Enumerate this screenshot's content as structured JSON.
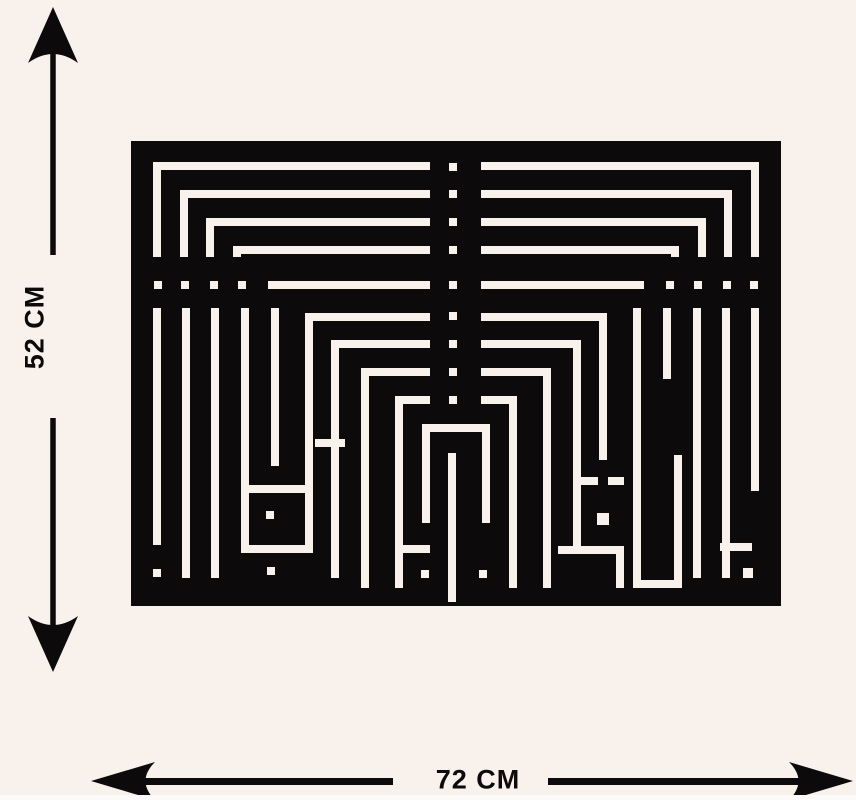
{
  "labels": {
    "height": "52 CM",
    "width": "72 CM"
  },
  "colors": {
    "background": "#f8f1ec",
    "ink": "#0d0a0b",
    "artwork_black": "#0d0a0b",
    "artwork_line": "#f8f1ec"
  },
  "artwork": {
    "type": "square-kufic-calligraphy-wall-art",
    "x": 131,
    "y": 141,
    "width": 650,
    "height": 465,
    "line_thickness": 8,
    "white_rects": [
      [
        22,
        21,
        277,
        8
      ],
      [
        350,
        21,
        278,
        8
      ],
      [
        22,
        21,
        8,
        95
      ],
      [
        620,
        21,
        8,
        95
      ],
      [
        49,
        49,
        250,
        8
      ],
      [
        350,
        49,
        251,
        8
      ],
      [
        49,
        49,
        8,
        67
      ],
      [
        593,
        49,
        8,
        67
      ],
      [
        75,
        77,
        224,
        8
      ],
      [
        350,
        77,
        225,
        8
      ],
      [
        75,
        77,
        8,
        39
      ],
      [
        567,
        77,
        8,
        39
      ],
      [
        102,
        105,
        197,
        8
      ],
      [
        350,
        105,
        198,
        8
      ],
      [
        102,
        105,
        8,
        11
      ],
      [
        540,
        105,
        8,
        11
      ],
      [
        137,
        140,
        162,
        8
      ],
      [
        350,
        140,
        163,
        8
      ],
      [
        23,
        140,
        8,
        8
      ],
      [
        50,
        140,
        8,
        8
      ],
      [
        79,
        140,
        8,
        8
      ],
      [
        107,
        140,
        8,
        8
      ],
      [
        535,
        140,
        8,
        8
      ],
      [
        563,
        140,
        8,
        8
      ],
      [
        592,
        140,
        8,
        8
      ],
      [
        619,
        140,
        8,
        8
      ],
      [
        318,
        22,
        8,
        8
      ],
      [
        318,
        49,
        8,
        8
      ],
      [
        318,
        77,
        8,
        8
      ],
      [
        318,
        105,
        8,
        8
      ],
      [
        318,
        140,
        8,
        8
      ],
      [
        318,
        171,
        8,
        8
      ],
      [
        318,
        199,
        8,
        8
      ],
      [
        318,
        227,
        8,
        8
      ],
      [
        318,
        255,
        8,
        8
      ],
      [
        174,
        172,
        125,
        8
      ],
      [
        174,
        172,
        8,
        240
      ],
      [
        200,
        199,
        99,
        8
      ],
      [
        200,
        199,
        8,
        238
      ],
      [
        350,
        172,
        123,
        8
      ],
      [
        468,
        172,
        8,
        147
      ],
      [
        350,
        199,
        100,
        8
      ],
      [
        442,
        199,
        8,
        214
      ],
      [
        230,
        227,
        69,
        8
      ],
      [
        350,
        227,
        70,
        8
      ],
      [
        230,
        227,
        8,
        220
      ],
      [
        412,
        227,
        8,
        220
      ],
      [
        264,
        255,
        35,
        8
      ],
      [
        350,
        255,
        36,
        8
      ],
      [
        264,
        255,
        8,
        192
      ],
      [
        378,
        255,
        8,
        192
      ],
      [
        291,
        283,
        68,
        8
      ],
      [
        291,
        283,
        8,
        99
      ],
      [
        351,
        283,
        8,
        99
      ],
      [
        264,
        404,
        35,
        8
      ],
      [
        290,
        429,
        8,
        8
      ],
      [
        348,
        429,
        8,
        8
      ],
      [
        317,
        312,
        8,
        149
      ],
      [
        22,
        167,
        8,
        237
      ],
      [
        51,
        167,
        8,
        270
      ],
      [
        80,
        167,
        8,
        270
      ],
      [
        110,
        167,
        8,
        237
      ],
      [
        140,
        167,
        8,
        158
      ],
      [
        22,
        428,
        8,
        8
      ],
      [
        118,
        344,
        56,
        8
      ],
      [
        135,
        370,
        8,
        8
      ],
      [
        110,
        404,
        72,
        8
      ],
      [
        136,
        426,
        8,
        8
      ],
      [
        184,
        298,
        30,
        8
      ],
      [
        502,
        167,
        8,
        272
      ],
      [
        532,
        167,
        8,
        71
      ],
      [
        562,
        167,
        8,
        270
      ],
      [
        591,
        167,
        8,
        270
      ],
      [
        620,
        167,
        8,
        183
      ],
      [
        444,
        336,
        23,
        8
      ],
      [
        477,
        336,
        16,
        8
      ],
      [
        466,
        372,
        12,
        12
      ],
      [
        427,
        405,
        66,
        8
      ],
      [
        485,
        413,
        8,
        34
      ],
      [
        502,
        439,
        49,
        8
      ],
      [
        543,
        314,
        8,
        125
      ],
      [
        589,
        402,
        32,
        8
      ],
      [
        612,
        427,
        10,
        10
      ]
    ]
  }
}
